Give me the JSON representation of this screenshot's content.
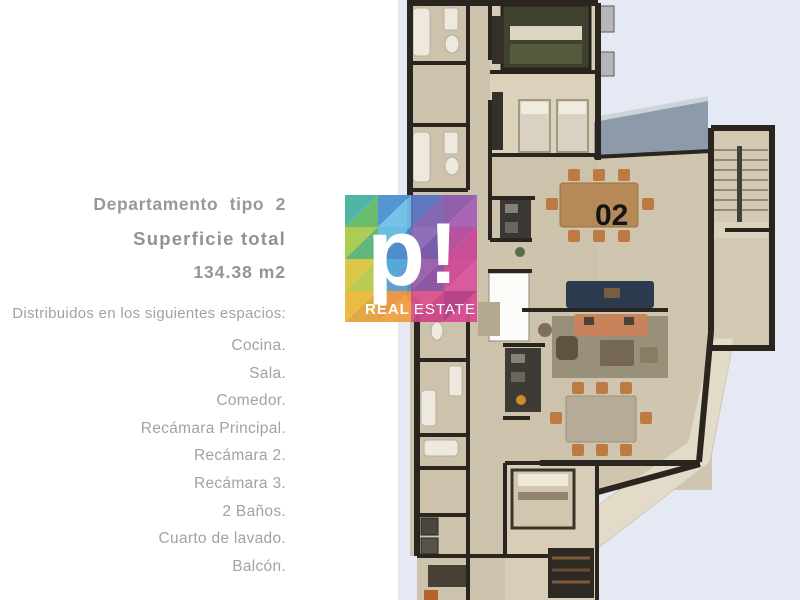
{
  "panel": {
    "title": "Departamento tipo 2",
    "subtitle": "Superficie total",
    "area": "134.38 m2",
    "intro": "Distribuidos en los siguientes espacios:",
    "spaces": [
      "Cocina.",
      "Sala.",
      "Comedor.",
      "Recámara Principal.",
      "Recámara 2.",
      "Recámara 3.",
      "2 Baños.",
      "Cuarto de lavado.",
      "Balcón."
    ]
  },
  "logo": {
    "letter": "p",
    "exclamation": "!",
    "brand_bold": "REAL",
    "brand_light": "ESTATE"
  },
  "floorplan": {
    "unit_label": "02"
  },
  "colors": {
    "panel_background": "#e4e9f3",
    "floor": "#d2c7b0",
    "walls": "#2b251f",
    "roof_accent": "#8d9aa9",
    "navy_sofa": "#2c3a4f",
    "orange_sofa": "#c8825c",
    "text_gray": "#9b9b9b"
  }
}
